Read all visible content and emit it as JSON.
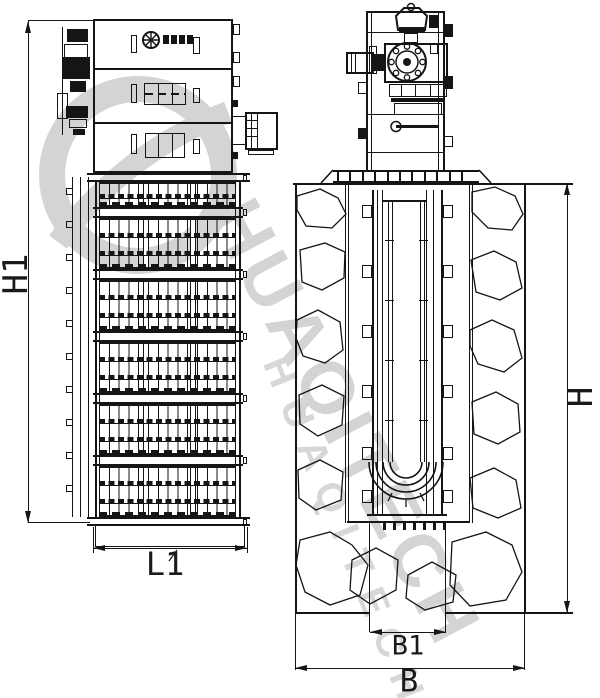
{
  "drawing": {
    "kind": "mechanical grab screen installation drawing",
    "views": {
      "left": "front elevation",
      "right": "side elevation in channel"
    }
  },
  "dimensions": {
    "h1": "H1",
    "l1": "L1",
    "h": "H",
    "b1": "B1",
    "b": "B"
  },
  "watermark": {
    "brand_text": "HUAQITECH"
  },
  "colors": {
    "line": "#151515",
    "watermark": "#d4d4d4",
    "background": "#ffffff"
  }
}
